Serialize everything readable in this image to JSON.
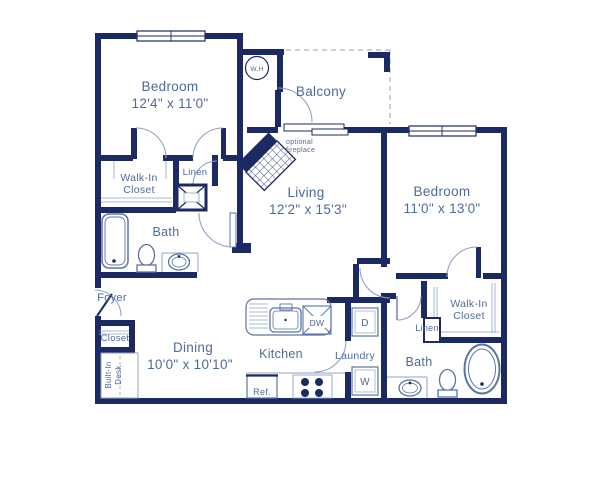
{
  "floorplan": {
    "rooms": {
      "bedroom1": {
        "name": "Bedroom",
        "dims": "12'4\" x 11'0\""
      },
      "bedroom2": {
        "name": "Bedroom",
        "dims": "11'0\" x 13'0\""
      },
      "living": {
        "name": "Living",
        "dims": "12'2\" x 15'3\""
      },
      "dining": {
        "name": "Dining",
        "dims": "10'0\" x 10'10\""
      },
      "kitchen": {
        "name": "Kitchen"
      },
      "laundry": {
        "name": "Laundry"
      },
      "balcony": {
        "name": "Balcony"
      },
      "bath1": {
        "name": "Bath"
      },
      "bath2": {
        "name": "Bath"
      },
      "foyer": {
        "name": "Foyer"
      },
      "closet": {
        "name": "Closet"
      },
      "walk_in_closet1": {
        "line1": "Walk-In",
        "line2": "Closet"
      },
      "walk_in_closet2": {
        "line1": "Walk-In",
        "line2": "Closet"
      },
      "linen1": {
        "name": "Linen"
      },
      "linen2": {
        "name": "Linen"
      },
      "built_in_desk": {
        "line1": "Built-In",
        "line2": "Desk"
      }
    },
    "features": {
      "water_heater": "W.H",
      "fireplace_line1": "optional",
      "fireplace_line2": "fireplace"
    },
    "appliances": {
      "dishwasher": "DW",
      "dryer": "D",
      "washer": "W",
      "refrigerator": "Ref."
    },
    "colors": {
      "wall": "#1b2a63",
      "label": "#4d6a9a",
      "fixture": "#5a74a5",
      "dashed": "#a8b6cc"
    }
  }
}
